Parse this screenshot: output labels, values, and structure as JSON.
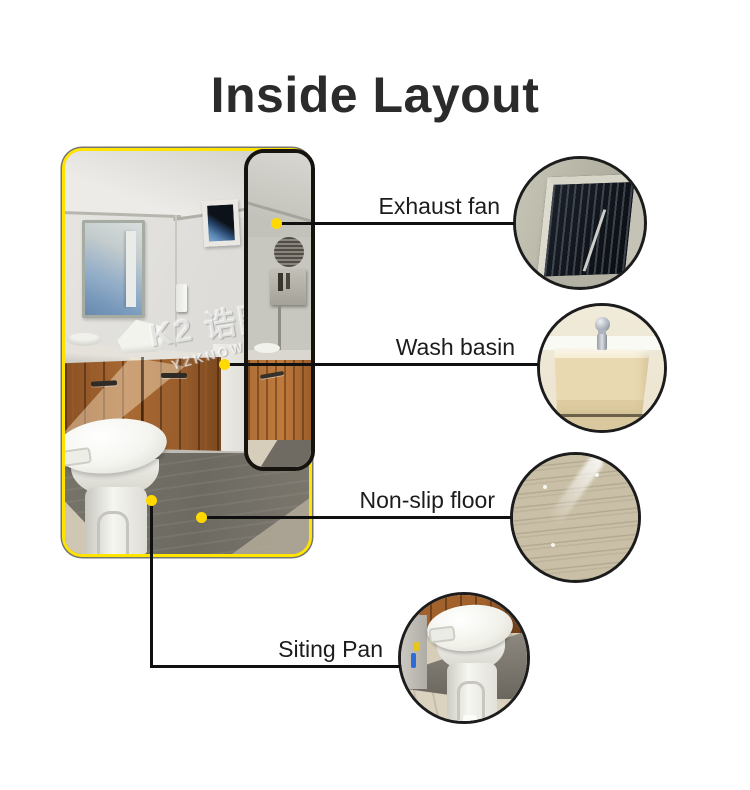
{
  "page": {
    "title": "Inside Layout",
    "background": "#ffffff"
  },
  "watermark": {
    "brand": "K2 诰图",
    "sub": "YZKNOWN"
  },
  "main_photo": {
    "description": "Portable toilet room interior photo with yellow border"
  },
  "callouts": [
    {
      "id": "exhaust-fan",
      "label": "Exhaust fan"
    },
    {
      "id": "wash-basin",
      "label": "Wash basin"
    },
    {
      "id": "non-slip-floor",
      "label": "Non-slip floor"
    },
    {
      "id": "siting-pan",
      "label": "Siting Pan"
    }
  ],
  "colors": {
    "photo_border": "#ffe400",
    "callout_line": "#101010",
    "callout_dot": "#ffd900",
    "circle_border": "#1c1c1c",
    "label_text": "#1c1c1c",
    "title_text": "#2b2b2b"
  }
}
